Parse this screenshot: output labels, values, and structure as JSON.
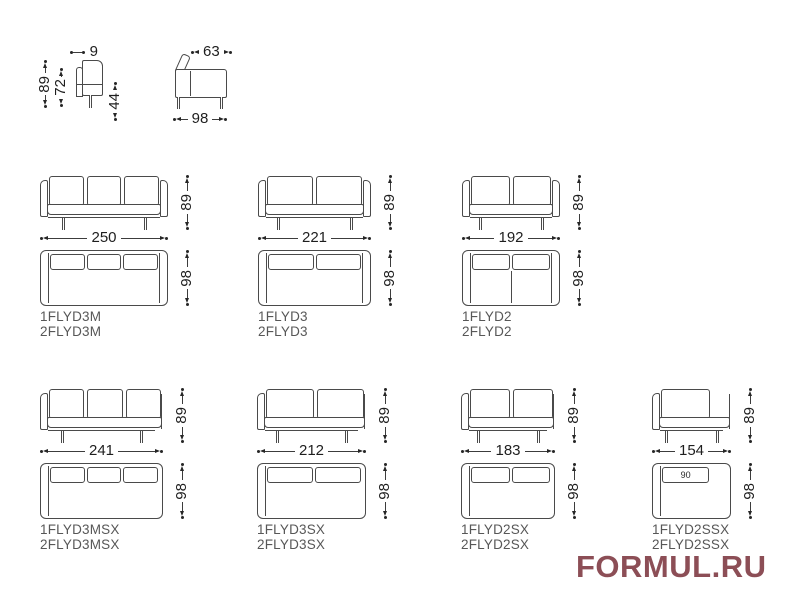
{
  "watermark": {
    "text": "FORMUL.RU",
    "color": "#8c4e56"
  },
  "colors": {
    "line": "#4a4a4a",
    "dimension": "#262626",
    "dimension_text": "#1e1e1e",
    "code_text": "#575757"
  },
  "side_views": {
    "arm_section": {
      "arm_width": "9",
      "total_height": "89",
      "back_height": "72",
      "seat_height": "44"
    },
    "side_profile": {
      "back_depth": "63",
      "total_depth": "98"
    }
  },
  "sofas": [
    {
      "code_line1": "1FLYD3M",
      "code_line2": "2FLYD3M",
      "width": "250",
      "height": "89",
      "depth": "98"
    },
    {
      "code_line1": "1FLYD3",
      "code_line2": "2FLYD3",
      "width": "221",
      "height": "89",
      "depth": "98"
    },
    {
      "code_line1": "1FLYD2",
      "code_line2": "2FLYD2",
      "width": "192",
      "height": "89",
      "depth": "98"
    },
    {
      "code_line1": "1FLYD3MSX",
      "code_line2": "2FLYD3MSX",
      "width": "241",
      "height": "89",
      "depth": "98"
    },
    {
      "code_line1": "1FLYD3SX",
      "code_line2": "2FLYD3SX",
      "width": "212",
      "height": "89",
      "depth": "98"
    },
    {
      "code_line1": "1FLYD2SX",
      "code_line2": "2FLYD2SX",
      "width": "183",
      "height": "89",
      "depth": "98"
    },
    {
      "code_line1": "1FLYD2SSX",
      "code_line2": "2FLYD2SSX",
      "width": "154",
      "height": "89",
      "depth": "98",
      "seat_width": "90"
    }
  ]
}
